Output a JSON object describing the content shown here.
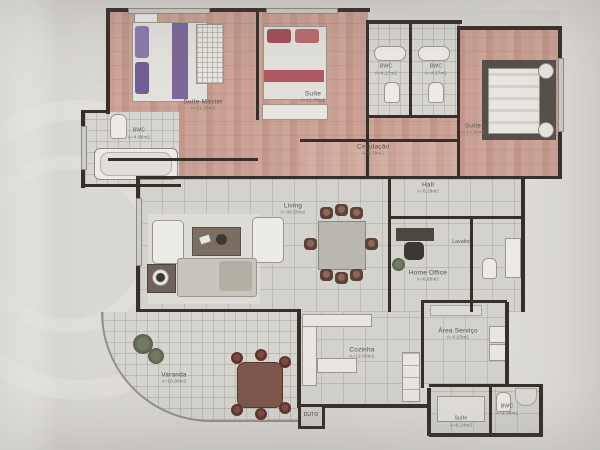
{
  "document": {
    "kind": "apartment floor plan photo"
  },
  "rooms": {
    "suite_master": {
      "label": "Suíte Master",
      "area": "A=21,25m2"
    },
    "suite_2": {
      "label": "Suíte",
      "area": "A=12,08m2"
    },
    "bwc_top_1": {
      "label": "BWC",
      "area": "A=4,27m2"
    },
    "bwc_top_2": {
      "label": "BWC",
      "area": "A=4,27m2"
    },
    "suite_3": {
      "label": "Suíte",
      "area": "A=14,96m2"
    },
    "bwc_master": {
      "label": "BWC",
      "area": "A=4,86m2"
    },
    "circulacao": {
      "label": "Circulação",
      "area": "A=8,79m2"
    },
    "hall": {
      "label": "Hall",
      "area": "A=8,29m2"
    },
    "living": {
      "label": "Living",
      "area": "A=36,55m2"
    },
    "home_office": {
      "label": "Home Office",
      "area": "A=6,68m2"
    },
    "lavabo": {
      "label": "Lavabo",
      "area": ""
    },
    "cozinha": {
      "label": "Cozinha",
      "area": "A=12,08m2"
    },
    "area_servico": {
      "label": "Área Serviço",
      "area": "A=6,63m2"
    },
    "varanda": {
      "label": "Varanda",
      "area": "A=16,88m2"
    },
    "duto": {
      "label": "DUTO",
      "area": ""
    },
    "suite_servico": {
      "label": "Suíte",
      "area": "A=6,14m2"
    },
    "bwc_servico": {
      "label": "BWC",
      "area": "A=2,38m2"
    }
  },
  "colors": {
    "wall": "#36302b",
    "wood_floor": "#c89f93",
    "wood_floor_light": "#cfa99d",
    "tile_floor": "#d3d2cd",
    "paper": "#d7d5d0",
    "bed_purple": "#7b6898",
    "bed_red": "#b05a62",
    "balcony_chair": "#5e332c"
  }
}
